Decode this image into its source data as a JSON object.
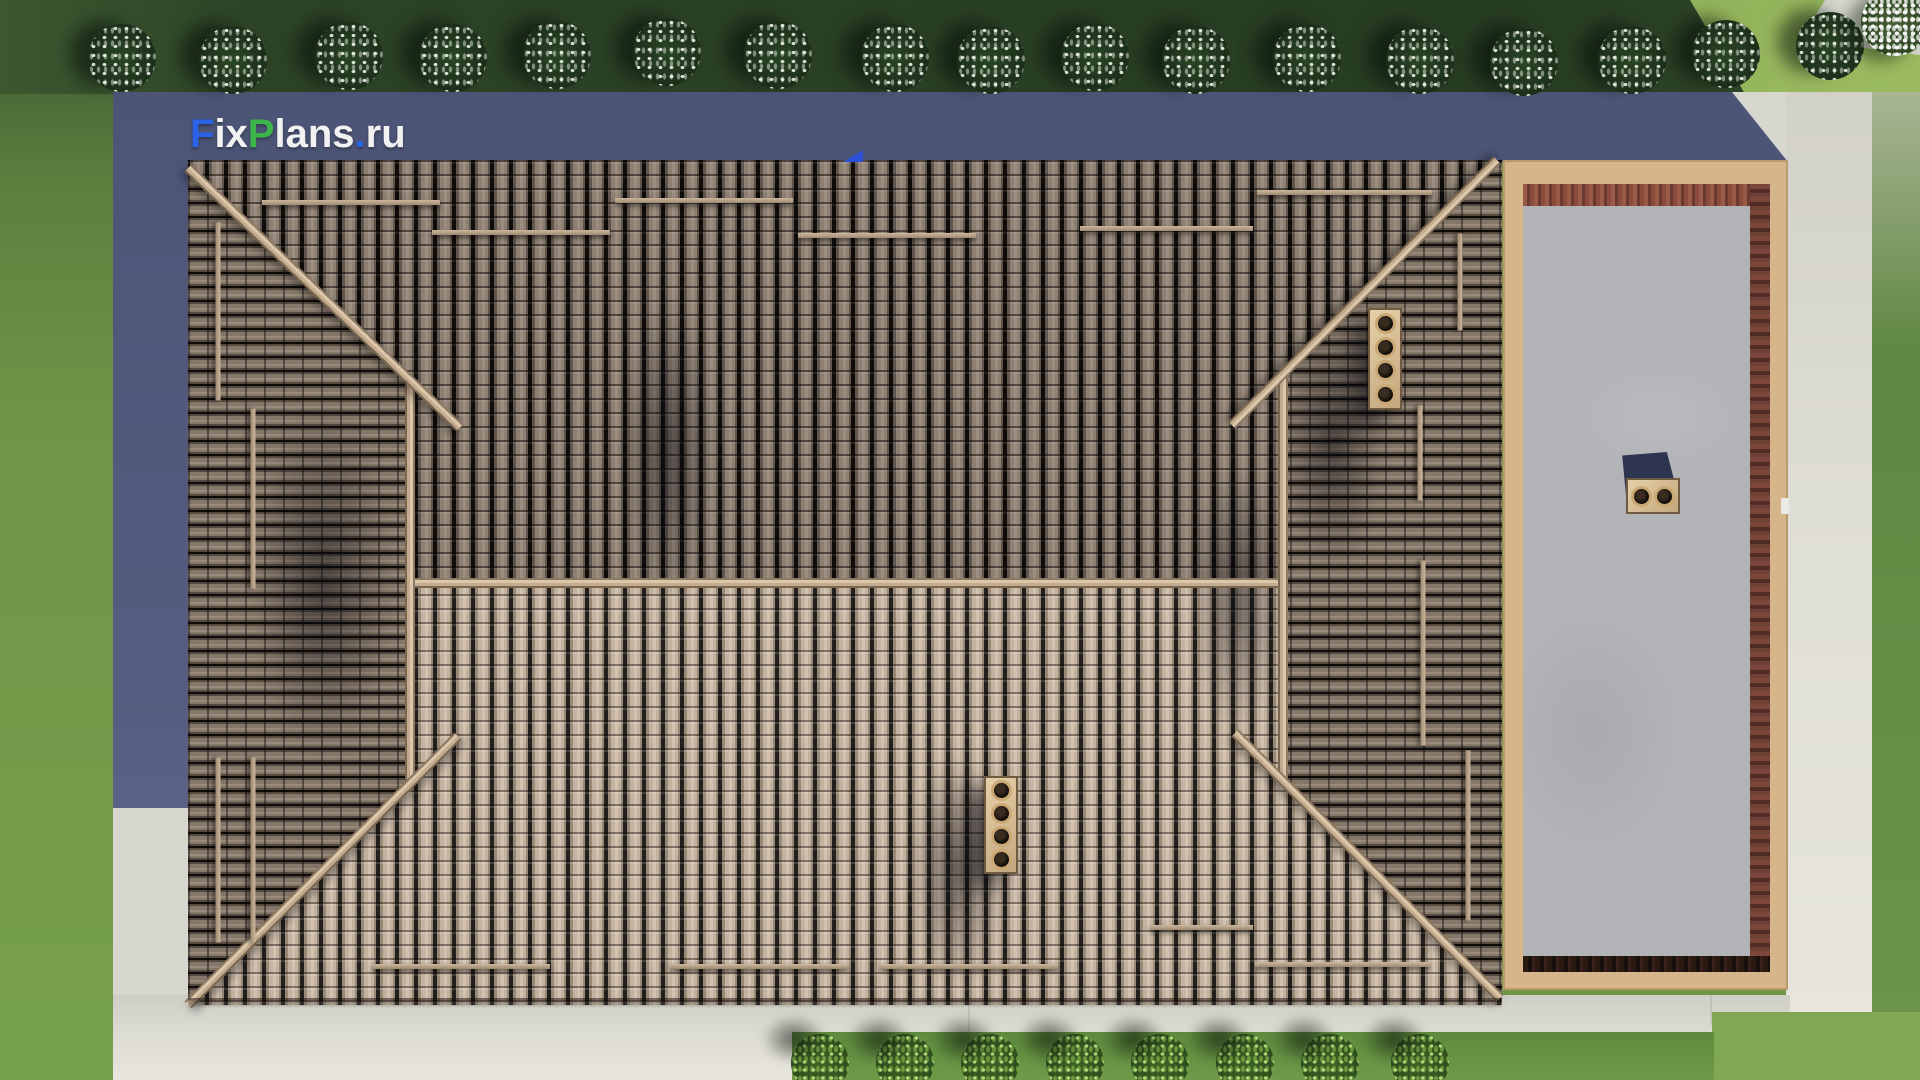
{
  "watermark": {
    "f": "F",
    "ix": "ix",
    "p": "P",
    "lans": "lans",
    "dot": ".",
    "ru": "ru"
  },
  "palette": {
    "watermark_blue": "#2b63e8",
    "watermark_green": "#3cb54a",
    "watermark_white": "#f2f2f2",
    "grass_top": "#2c4326",
    "grass_side": "#6f9547",
    "grass_lit": "#9cbb60",
    "concrete": "#d8d7cf",
    "cast_shadow": "#4d5577",
    "tile_dark": "#8d7f72",
    "tile_light": "#c4b2a0",
    "ridge_wood": "#dcc7ab",
    "frame_wood": "#d6b58a",
    "brick": "#8a4a3c",
    "slab_gray": "#b2b3b6",
    "chimney_tan": "#ddc49e",
    "flag_blue": "#2b50d8"
  },
  "scene": {
    "trees": [
      {
        "x": 122,
        "y": 58
      },
      {
        "x": 233,
        "y": 60
      },
      {
        "x": 349,
        "y": 56
      },
      {
        "x": 453,
        "y": 58
      },
      {
        "x": 557,
        "y": 55
      },
      {
        "x": 667,
        "y": 52
      },
      {
        "x": 778,
        "y": 55
      },
      {
        "x": 895,
        "y": 58
      },
      {
        "x": 991,
        "y": 60
      },
      {
        "x": 1095,
        "y": 57
      },
      {
        "x": 1196,
        "y": 60
      },
      {
        "x": 1307,
        "y": 58
      },
      {
        "x": 1420,
        "y": 60
      },
      {
        "x": 1524,
        "y": 62
      },
      {
        "x": 1632,
        "y": 60
      },
      {
        "x": 1726,
        "y": 54
      },
      {
        "x": 1830,
        "y": 46
      },
      {
        "x": 1895,
        "y": 22,
        "bright": true
      }
    ],
    "bushes": [
      {
        "x": 820
      },
      {
        "x": 905
      },
      {
        "x": 990
      },
      {
        "x": 1075
      },
      {
        "x": 1160
      },
      {
        "x": 1245
      },
      {
        "x": 1330
      },
      {
        "x": 1420
      }
    ],
    "bush_cy": 1063,
    "roof": {
      "ridges": [
        {
          "x": 222,
          "y": 423,
          "len": 873,
          "angle": 0,
          "hip": false
        },
        {
          "x": 222,
          "y": 220,
          "len": 403,
          "angle": 90,
          "hip": false
        },
        {
          "x": 1095,
          "y": 215,
          "len": 405,
          "angle": 90,
          "hip": false
        },
        {
          "x": 0,
          "y": 8,
          "len": 376,
          "angle": 43.7,
          "hip": true
        },
        {
          "x": 1309,
          "y": 0,
          "len": 375,
          "angle": 135,
          "hip": true
        },
        {
          "x": 0,
          "y": 845,
          "len": 381,
          "angle": -44.9,
          "hip": true
        },
        {
          "x": 1047,
          "y": 573,
          "len": 375,
          "angle": 45,
          "hip": true
        }
      ],
      "snow_guards": [
        {
          "x": 74,
          "y": 42,
          "len": 178,
          "angle": 0
        },
        {
          "x": 244,
          "y": 72,
          "len": 178,
          "angle": 0
        },
        {
          "x": 427,
          "y": 40,
          "len": 178,
          "angle": 0
        },
        {
          "x": 610,
          "y": 75,
          "len": 178,
          "angle": 0
        },
        {
          "x": 892,
          "y": 68,
          "len": 173,
          "angle": 0
        },
        {
          "x": 1069,
          "y": 32,
          "len": 175,
          "angle": 0
        },
        {
          "x": 184,
          "y": 806,
          "len": 178,
          "angle": 0
        },
        {
          "x": 482,
          "y": 806,
          "len": 178,
          "angle": 0
        },
        {
          "x": 692,
          "y": 806,
          "len": 178,
          "angle": 0
        },
        {
          "x": 1067,
          "y": 804,
          "len": 175,
          "angle": 0
        },
        {
          "x": 962,
          "y": 767,
          "len": 103,
          "angle": 0
        },
        {
          "x": 30,
          "y": 62,
          "len": 178,
          "angle": 90
        },
        {
          "x": 65,
          "y": 248,
          "len": 180,
          "angle": 90
        },
        {
          "x": 30,
          "y": 597,
          "len": 185,
          "angle": 90
        },
        {
          "x": 65,
          "y": 597,
          "len": 185,
          "angle": 90
        },
        {
          "x": 1272,
          "y": 73,
          "len": 97,
          "angle": 90
        },
        {
          "x": 1232,
          "y": 245,
          "len": 95,
          "angle": 90
        },
        {
          "x": 1235,
          "y": 400,
          "len": 185,
          "angle": 90
        },
        {
          "x": 1280,
          "y": 590,
          "len": 170,
          "angle": 90
        }
      ],
      "shadow_blobs": [
        {
          "x": 60,
          "y": 230,
          "w": 150,
          "h": 380
        },
        {
          "x": 430,
          "y": 130,
          "w": 100,
          "h": 320
        },
        {
          "x": 1090,
          "y": 140,
          "w": 110,
          "h": 280
        },
        {
          "x": 720,
          "y": 590,
          "w": 100,
          "h": 240
        },
        {
          "x": 1000,
          "y": 300,
          "w": 100,
          "h": 280
        }
      ],
      "chimneys": [
        {
          "x": 1180,
          "y": 148,
          "w": 34,
          "h": 102,
          "flues": 4
        },
        {
          "x": 796,
          "y": 616,
          "w": 34,
          "h": 98,
          "flues": 4
        }
      ]
    },
    "flat_roof_chimney_flues": 2
  }
}
